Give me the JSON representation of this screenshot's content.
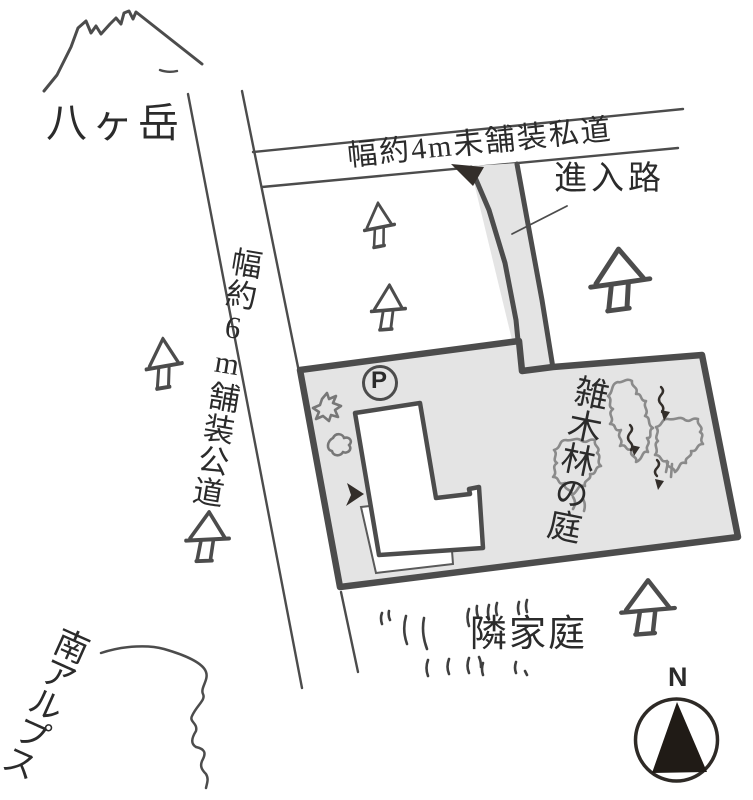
{
  "labels": {
    "mountain_northwest": "八ヶ岳",
    "mountain_southwest": "南アルプス",
    "private_road": "幅約4m未舗装私道",
    "public_road": "幅約6m舗装公道",
    "approach_road": "進入路",
    "woods_garden": "雑木林の庭",
    "neighbor_garden": "隣家庭",
    "parking_mark": "P",
    "compass_north": "N"
  },
  "colors": {
    "plot_fill": "#e4e4e4",
    "outline": "#4c4c4c",
    "ink": "#2b2b2b",
    "scribble": "#8a8a8a"
  }
}
